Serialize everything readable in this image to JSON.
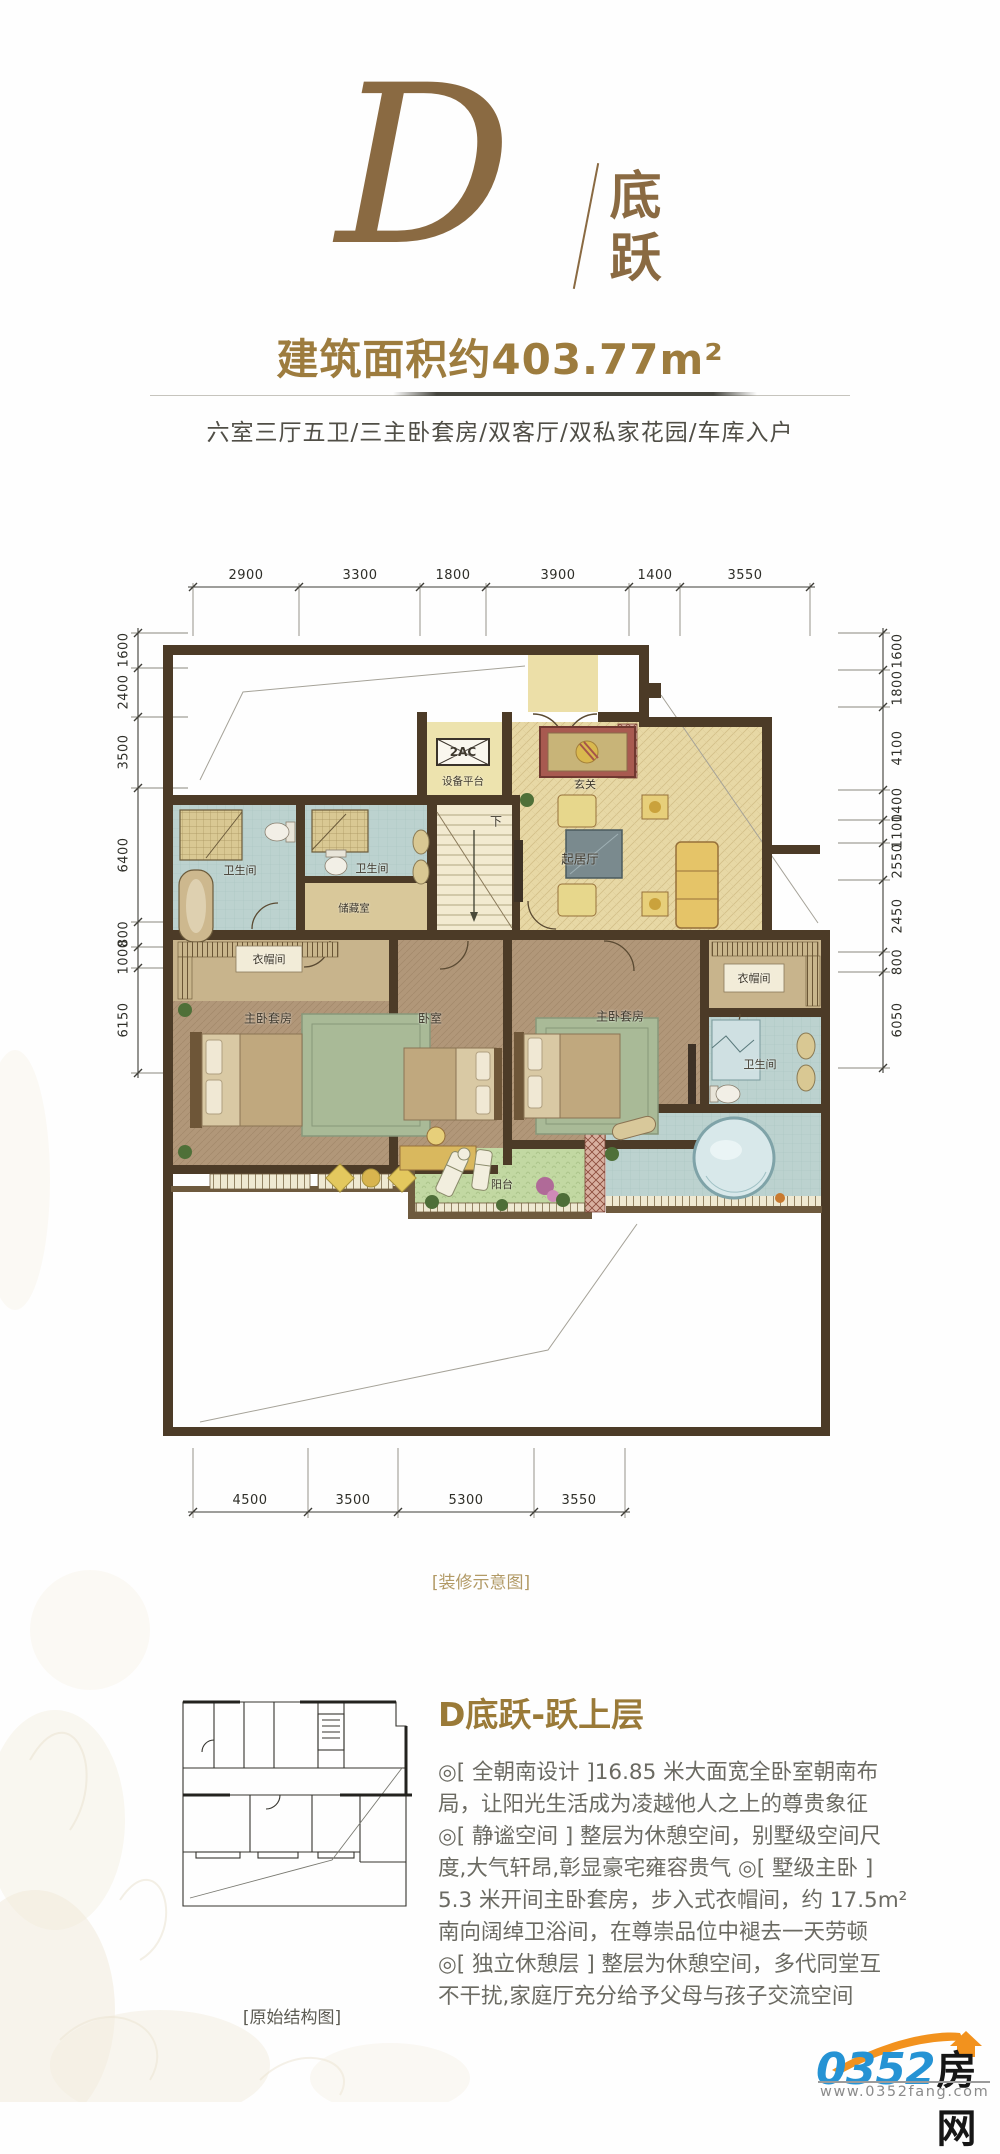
{
  "brand": {
    "letter": "D",
    "name_vertical": "底跃",
    "accent_color": "#8a6a42"
  },
  "header": {
    "area_title": "建筑面积约403.77m²",
    "tagline": "六室三厅五卫/三主卧套房/双客厅/双私家花园/车库入户",
    "title_color": "#9d7c3e"
  },
  "plan": {
    "caption": "[装修示意图]",
    "rooms": {
      "equipment": "设备平台",
      "ac_unit": "2AC",
      "foyer": "玄关",
      "living": "起居厅",
      "down": "下",
      "bath_a": "卫生间",
      "bath_b": "卫生间",
      "storage": "储藏室",
      "closet_left": "衣帽间",
      "master_left": "主卧套房",
      "bedroom": "卧室",
      "master_right": "主卧套房",
      "closet_right": "衣帽间",
      "bath_right": "卫生间",
      "balcony": "阳台"
    },
    "dims": {
      "top": [
        "2900",
        "3300",
        "1800",
        "3900",
        "1400",
        "3550"
      ],
      "bottom": [
        "4500",
        "3500",
        "5300",
        "3550"
      ],
      "left": [
        "1600",
        "2400",
        "3500",
        "6400",
        "800",
        "1000",
        "6150"
      ],
      "right": [
        "1600",
        "1800",
        "4100",
        "1400",
        "1100",
        "2550",
        "2450",
        "800",
        "6050"
      ]
    },
    "wall_color": "#4c3b27"
  },
  "thumbnail": {
    "caption": "[原始结构图]"
  },
  "details": {
    "title": "D底跃-跃上层",
    "paragraph_lines": [
      "◎[ 全朝南设计 ]16.85 米大面宽全卧室朝南布",
      "局，让阳光生活成为凌越他人之上的尊贵象征",
      "◎[ 静谧空间 ] 整层为休憩空间，别墅级空间尺",
      "度,大气轩昂,彰显豪宅雍容贵气 ◎[ 墅级主卧 ]",
      "5.3 米开间主卧套房，步入式衣帽间，约 17.5m²",
      "南向阔绰卫浴间，在尊崇品位中褪去一天劳顿",
      "◎[ 独立休憩层 ] 整层为休憩空间，多代同堂互",
      "不干扰,家庭厅充分给予父母与孩子交流空间"
    ]
  },
  "footer_logo": {
    "number": "0352",
    "suffix": "房网",
    "url": "www.0352fang.com",
    "blue": "#2593d4",
    "orange": "#f2921e"
  }
}
